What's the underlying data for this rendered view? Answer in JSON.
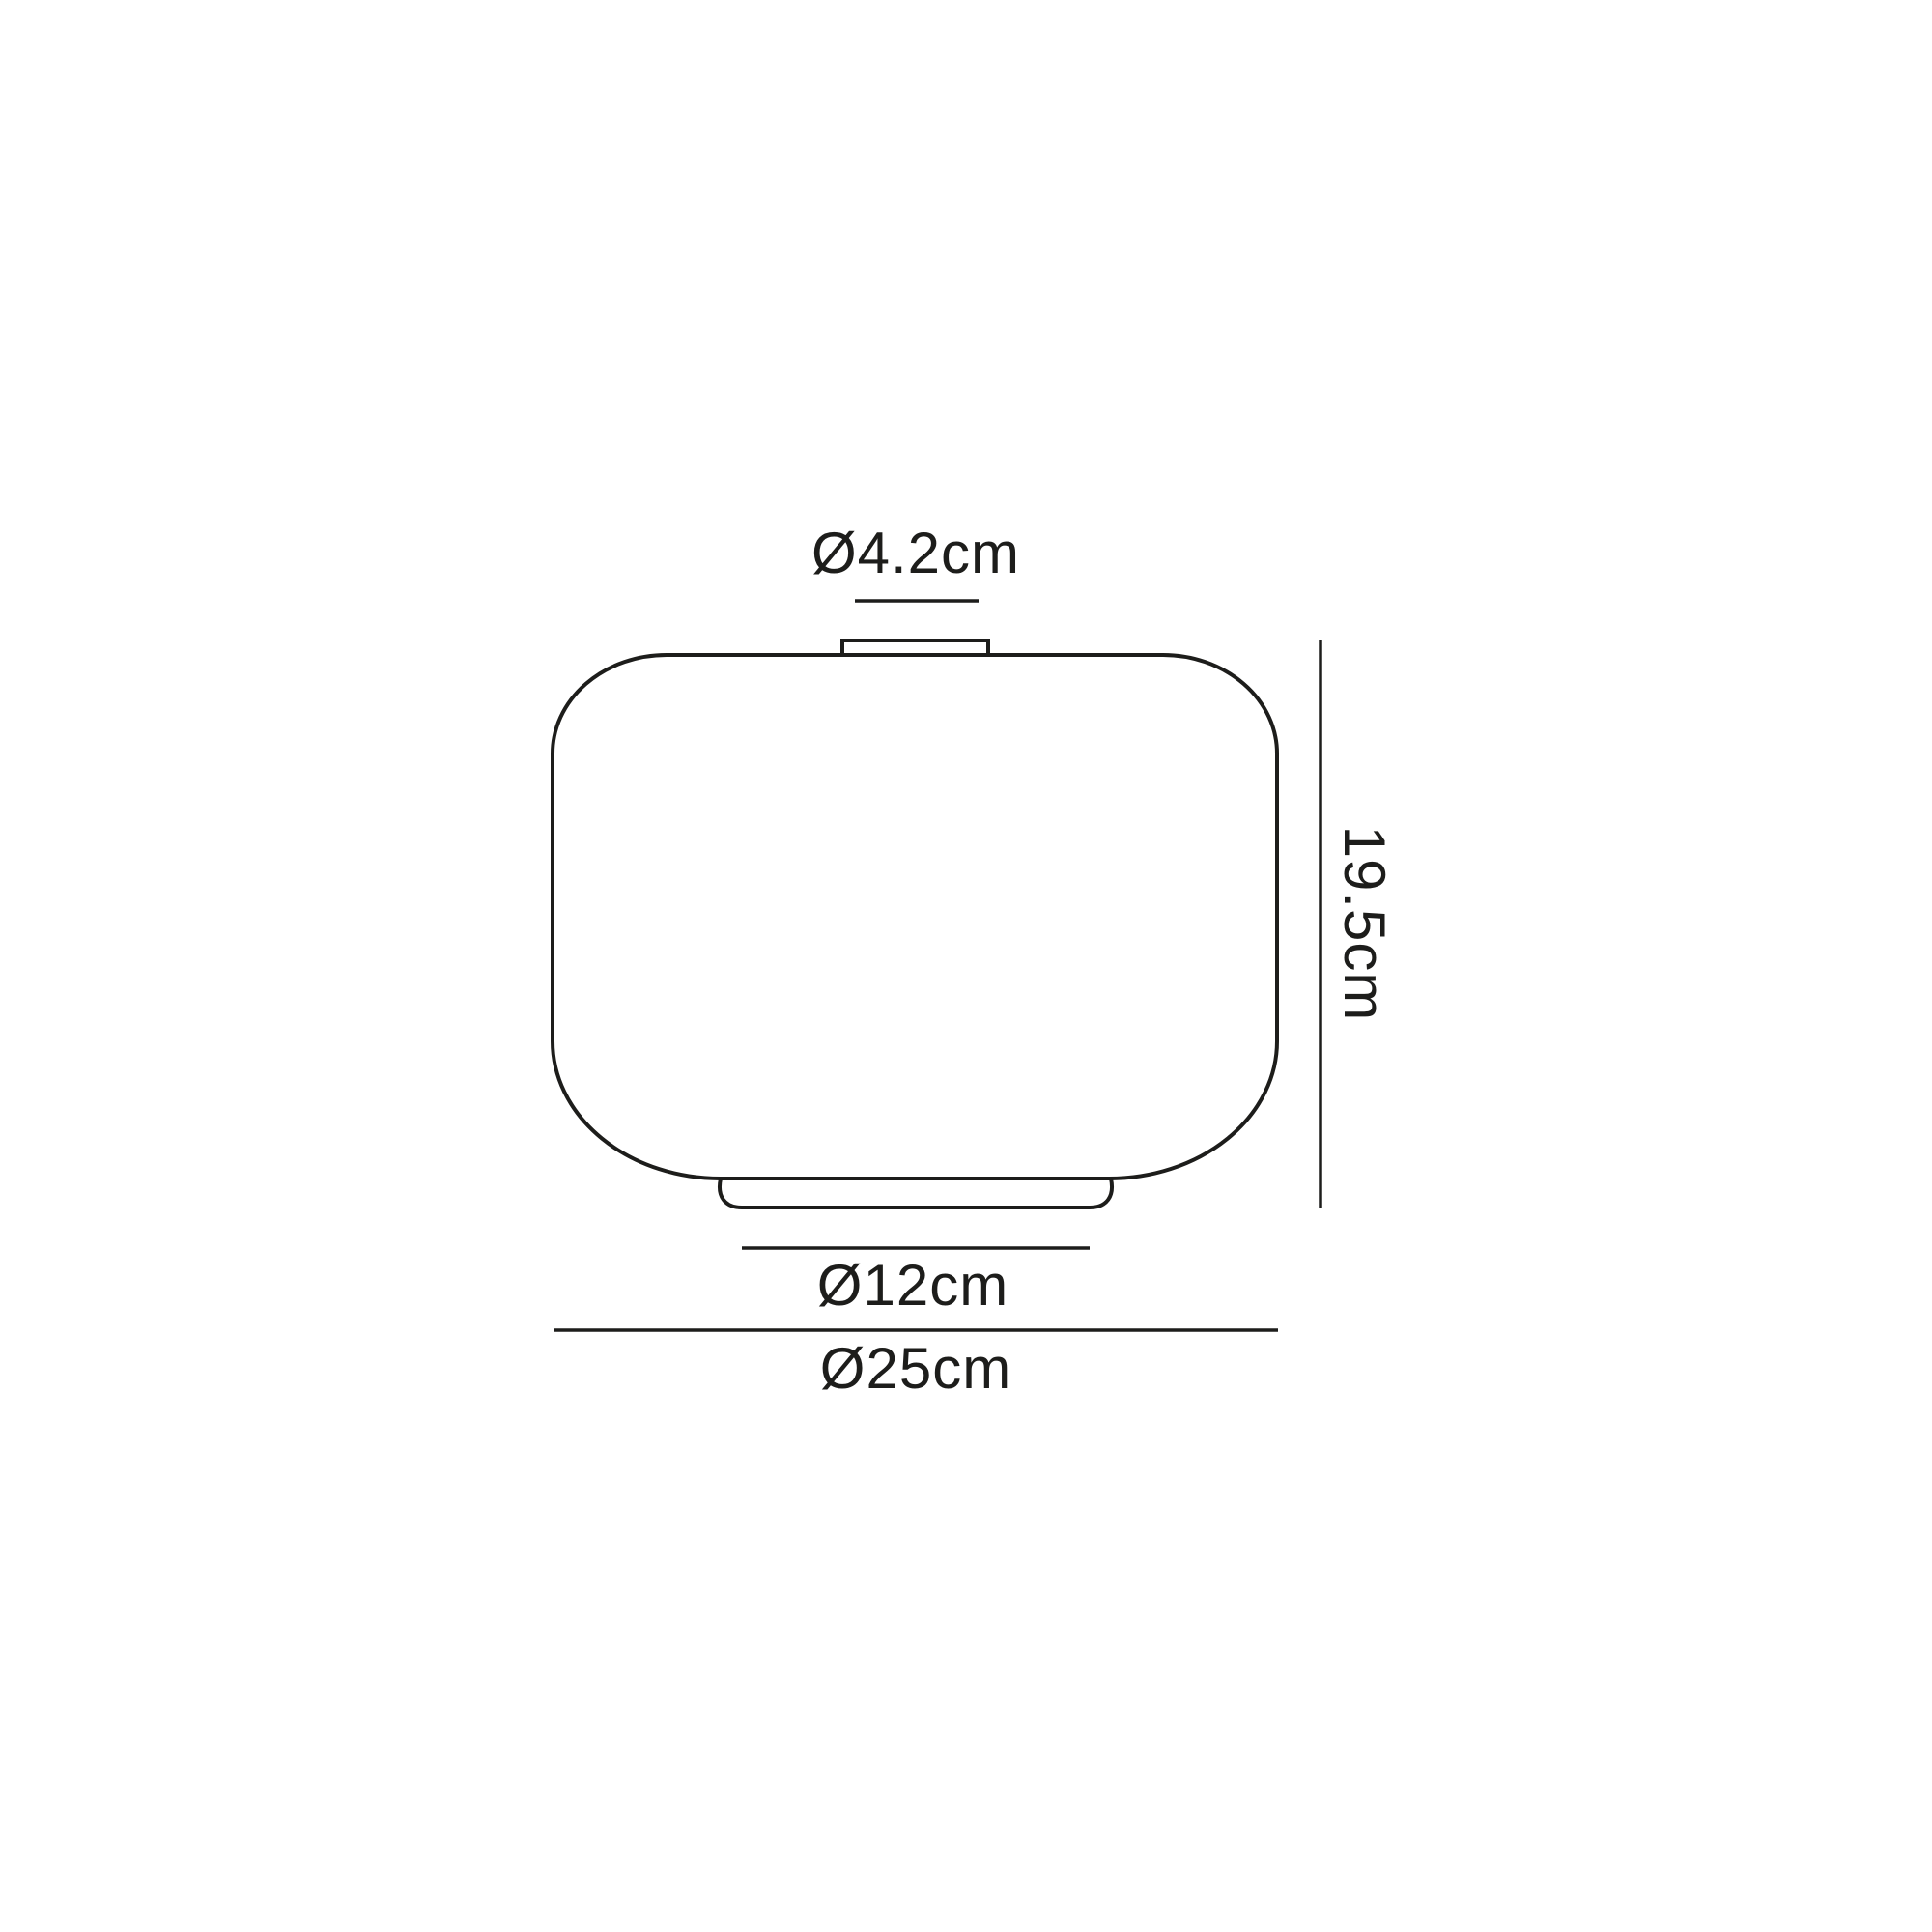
{
  "drawing": {
    "type": "technical-dimension-diagram",
    "subject": "lamp-shade-profile",
    "ink_color": "#1d1d1b",
    "background_color": "#ffffff",
    "dimensions": {
      "neck_diameter": {
        "label": "Ø4.2cm"
      },
      "height": {
        "label": "19.5cm"
      },
      "base_diameter": {
        "label": "Ø12cm"
      },
      "overall_diameter": {
        "label": "Ø25cm"
      }
    }
  }
}
